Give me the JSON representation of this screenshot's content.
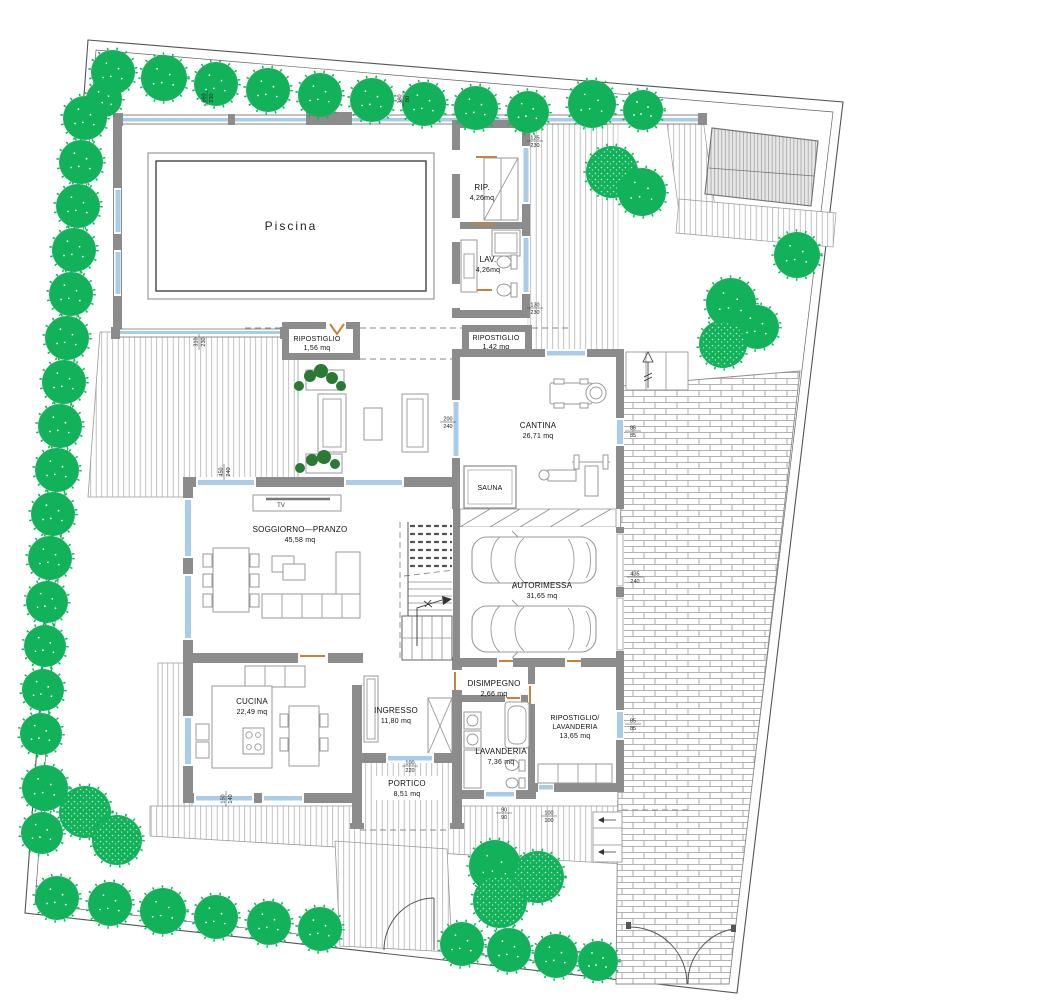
{
  "plan": {
    "rooms": {
      "piscina": {
        "label": "Piscina"
      },
      "rip": {
        "label": "RIP.",
        "area": "4,26mq"
      },
      "lav": {
        "label": "LAV.",
        "area": "4,26mq"
      },
      "ripostiglio1": {
        "label": "RIPOSTIGLIO",
        "area": "1,56 mq"
      },
      "ripostiglio2": {
        "label": "RIPOSTIGLIO",
        "area": "1,42 mq"
      },
      "cantina": {
        "label": "CANTINA",
        "area": "26,71 mq"
      },
      "sauna": {
        "label": "SAUNA"
      },
      "soggiorno": {
        "label": "SOGGIORNO—PRANZO",
        "area": "45,58 mq"
      },
      "tv": {
        "label": "TV"
      },
      "autorimessa": {
        "label": "AUTORIMESSA",
        "area": "31,65 mq"
      },
      "cucina": {
        "label": "CUCINA",
        "area": "22,49 mq"
      },
      "ingresso": {
        "label": "INGRESSO",
        "area": "11,80 mq"
      },
      "disimpegno": {
        "label": "DISIMPEGNO",
        "area": "2,66 mq"
      },
      "lavanderia": {
        "label": "LAVANDERIA",
        "area": "7,36 mq"
      },
      "ripostiglioLavanderia": {
        "label": "RIPOSTIGLIO/",
        "label2": "LAVANDERIA",
        "area": "13,65 mq"
      },
      "portico": {
        "label": "PORTICO",
        "area": "8,51 mq"
      }
    },
    "dimensions": [
      {
        "x": 535,
        "y": 141,
        "a": "125",
        "b": "230",
        "rot": 0
      },
      {
        "x": 535,
        "y": 308,
        "a": "130",
        "b": "230",
        "rot": 0
      },
      {
        "x": 448,
        "y": 422,
        "a": "200",
        "b": "240",
        "rot": 0
      },
      {
        "x": 633,
        "y": 431,
        "a": "85",
        "b": "85",
        "rot": 0
      },
      {
        "x": 635,
        "y": 577,
        "a": "435",
        "b": "240",
        "rot": 0
      },
      {
        "x": 633,
        "y": 724,
        "a": "85",
        "b": "85",
        "rot": 0
      },
      {
        "x": 504,
        "y": 813,
        "a": "90",
        "b": "90",
        "rot": 0
      },
      {
        "x": 549,
        "y": 816,
        "a": "100",
        "b": "100",
        "rot": 0
      },
      {
        "x": 410,
        "y": 766,
        "a": "100",
        "b": "220",
        "rot": 0
      },
      {
        "x": 226,
        "y": 799,
        "a": "150",
        "b": "140",
        "rot": -90
      },
      {
        "x": 207,
        "y": 98,
        "a": "660",
        "b": "230",
        "rot": -90
      },
      {
        "x": 403,
        "y": 99,
        "a": "380",
        "b": "80",
        "rot": -90
      },
      {
        "x": 199,
        "y": 342,
        "a": "310",
        "b": "230",
        "rot": -90
      },
      {
        "x": 224,
        "y": 472,
        "a": "450",
        "b": "240",
        "rot": -90
      }
    ],
    "trees": [
      {
        "x": 113,
        "y": 72,
        "r": 22,
        "t": "s"
      },
      {
        "x": 164,
        "y": 78,
        "r": 23,
        "t": "s"
      },
      {
        "x": 216,
        "y": 84,
        "r": 22,
        "t": "s"
      },
      {
        "x": 268,
        "y": 90,
        "r": 22,
        "t": "s"
      },
      {
        "x": 320,
        "y": 95,
        "r": 22,
        "t": "s"
      },
      {
        "x": 372,
        "y": 100,
        "r": 22,
        "t": "s"
      },
      {
        "x": 424,
        "y": 104,
        "r": 22,
        "t": "s"
      },
      {
        "x": 476,
        "y": 108,
        "r": 22,
        "t": "s"
      },
      {
        "x": 528,
        "y": 112,
        "r": 21,
        "t": "s"
      },
      {
        "x": 592,
        "y": 104,
        "r": 24,
        "t": "s"
      },
      {
        "x": 643,
        "y": 110,
        "r": 20,
        "t": "s"
      },
      {
        "x": 104,
        "y": 99,
        "r": 18,
        "t": "s"
      },
      {
        "x": 85,
        "y": 118,
        "r": 22,
        "t": "s"
      },
      {
        "x": 81,
        "y": 162,
        "r": 22,
        "t": "s"
      },
      {
        "x": 78,
        "y": 206,
        "r": 22,
        "t": "s"
      },
      {
        "x": 74,
        "y": 250,
        "r": 22,
        "t": "s"
      },
      {
        "x": 71,
        "y": 294,
        "r": 22,
        "t": "s"
      },
      {
        "x": 67,
        "y": 338,
        "r": 22,
        "t": "s"
      },
      {
        "x": 64,
        "y": 382,
        "r": 22,
        "t": "s"
      },
      {
        "x": 60,
        "y": 426,
        "r": 22,
        "t": "s"
      },
      {
        "x": 57,
        "y": 470,
        "r": 22,
        "t": "s"
      },
      {
        "x": 53,
        "y": 514,
        "r": 22,
        "t": "s"
      },
      {
        "x": 50,
        "y": 558,
        "r": 22,
        "t": "s"
      },
      {
        "x": 47,
        "y": 602,
        "r": 21,
        "t": "s"
      },
      {
        "x": 45,
        "y": 646,
        "r": 21,
        "t": "s"
      },
      {
        "x": 43,
        "y": 690,
        "r": 21,
        "t": "s"
      },
      {
        "x": 41,
        "y": 734,
        "r": 21,
        "t": "s"
      },
      {
        "x": 45,
        "y": 788,
        "r": 23,
        "t": "s"
      },
      {
        "x": 85,
        "y": 812,
        "r": 26,
        "t": "h"
      },
      {
        "x": 117,
        "y": 840,
        "r": 25,
        "t": "h"
      },
      {
        "x": 42,
        "y": 833,
        "r": 21,
        "t": "s"
      },
      {
        "x": 57,
        "y": 898,
        "r": 22,
        "t": "s"
      },
      {
        "x": 110,
        "y": 904,
        "r": 22,
        "t": "s"
      },
      {
        "x": 163,
        "y": 911,
        "r": 23,
        "t": "s"
      },
      {
        "x": 216,
        "y": 917,
        "r": 22,
        "t": "s"
      },
      {
        "x": 269,
        "y": 923,
        "r": 22,
        "t": "s"
      },
      {
        "x": 320,
        "y": 929,
        "r": 22,
        "t": "s"
      },
      {
        "x": 462,
        "y": 944,
        "r": 22,
        "t": "s"
      },
      {
        "x": 509,
        "y": 950,
        "r": 22,
        "t": "s"
      },
      {
        "x": 556,
        "y": 956,
        "r": 22,
        "t": "s"
      },
      {
        "x": 598,
        "y": 961,
        "r": 20,
        "t": "s"
      },
      {
        "x": 495,
        "y": 866,
        "r": 26,
        "t": "s"
      },
      {
        "x": 538,
        "y": 877,
        "r": 26,
        "t": "h"
      },
      {
        "x": 500,
        "y": 901,
        "r": 27,
        "t": "h"
      },
      {
        "x": 731,
        "y": 303,
        "r": 25,
        "t": "s"
      },
      {
        "x": 757,
        "y": 327,
        "r": 22,
        "t": "s"
      },
      {
        "x": 723,
        "y": 344,
        "r": 24,
        "t": "h"
      },
      {
        "x": 612,
        "y": 172,
        "r": 26,
        "t": "h"
      },
      {
        "x": 642,
        "y": 192,
        "r": 24,
        "t": "s"
      },
      {
        "x": 797,
        "y": 255,
        "r": 23,
        "t": "s"
      }
    ],
    "colors": {
      "tree": "#12b25a",
      "plant": "#2b7a33",
      "wall": "#8c8c8c",
      "window": "#a9cde9",
      "door": "#c8823c",
      "line": "#555555"
    }
  }
}
